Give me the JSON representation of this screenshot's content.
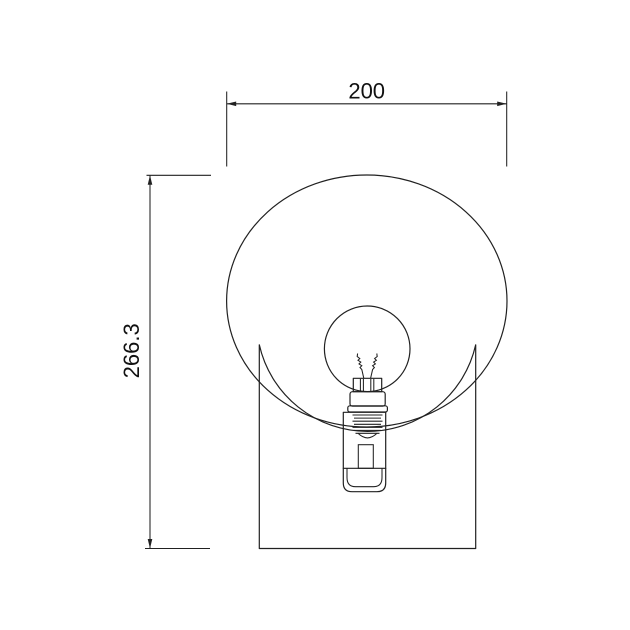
{
  "canvas": {
    "background": "#ffffff",
    "line_color": "#212121"
  },
  "drawing": {
    "subject": "wall sconce with spherical glass shade and filament bulb, front elevation",
    "dimensions": {
      "width_label": "200",
      "height_label": "266.3"
    }
  }
}
